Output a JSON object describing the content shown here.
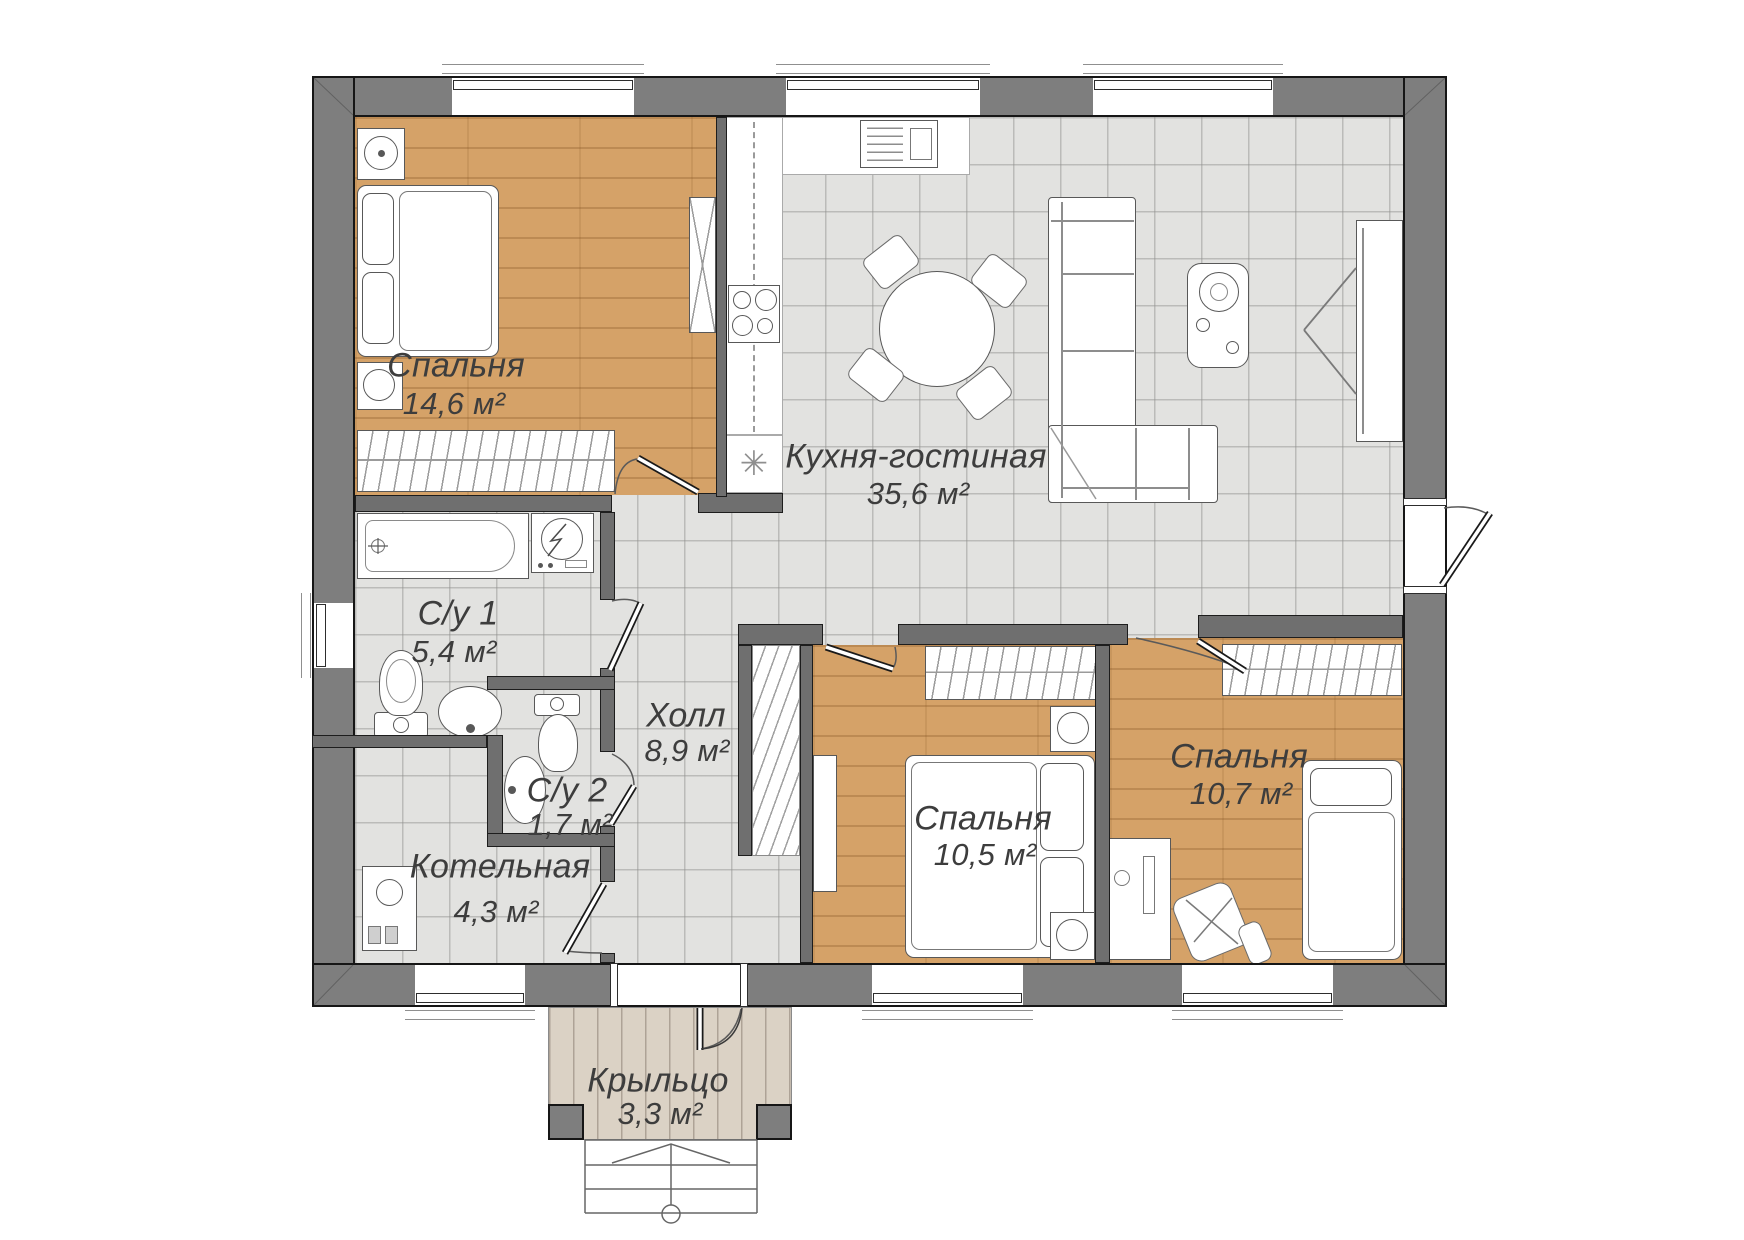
{
  "floor_plan": {
    "rooms": [
      {
        "id": "bedroom-1",
        "name": "Спальня",
        "area": "14,6 м²"
      },
      {
        "id": "kitchen-living",
        "name": "Кухня-гостиная",
        "area": "35,6 м²"
      },
      {
        "id": "bathroom-1",
        "name": "С/у 1",
        "area": "5,4 м²"
      },
      {
        "id": "bathroom-2",
        "name": "С/у 2",
        "area": "1,7 м²"
      },
      {
        "id": "hall",
        "name": "Холл",
        "area": "8,9 м²"
      },
      {
        "id": "boiler-room",
        "name": "Котельная",
        "area": "4,3 м²"
      },
      {
        "id": "bedroom-2",
        "name": "Спальня",
        "area": "10,5 м²"
      },
      {
        "id": "bedroom-3",
        "name": "Спальня",
        "area": "10,7 м²"
      },
      {
        "id": "porch",
        "name": "Крыльцо",
        "area": "3,3 м²"
      }
    ],
    "vent_symbol": "✳",
    "colors": {
      "exterior_wall": "#7e7e7e",
      "interior_wall": "#6f6f6f",
      "wood_floor": "#d5a268",
      "tile_floor": "#e2e2e0",
      "porch_floor": "#dbd2c5"
    }
  }
}
